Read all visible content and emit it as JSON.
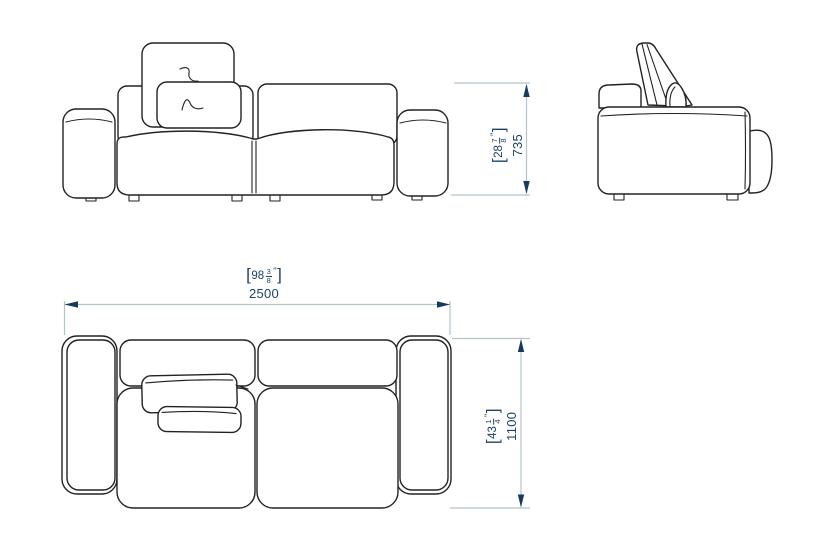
{
  "dimensions": {
    "height": {
      "inches_whole": "28",
      "fraction_numerator": "7",
      "fraction_denominator": "8",
      "inch_mark": "\"",
      "millimeters": "735"
    },
    "width": {
      "inches_whole": "98",
      "fraction_numerator": "3",
      "fraction_denominator": "8",
      "inch_mark": "\"",
      "millimeters": "2500"
    },
    "depth": {
      "inches_whole": "43",
      "fraction_numerator": "1",
      "fraction_denominator": "4",
      "inch_mark": "\"",
      "millimeters": "1100"
    }
  },
  "punctuation": {
    "bracket_open": "[",
    "bracket_close": "]"
  },
  "colors": {
    "drawing_stroke": "#222222",
    "dimension_line": "#b5c3cb",
    "dimension_arrow": "#1a3a5c",
    "dimension_text": "#1d4265",
    "background": "#ffffff"
  }
}
